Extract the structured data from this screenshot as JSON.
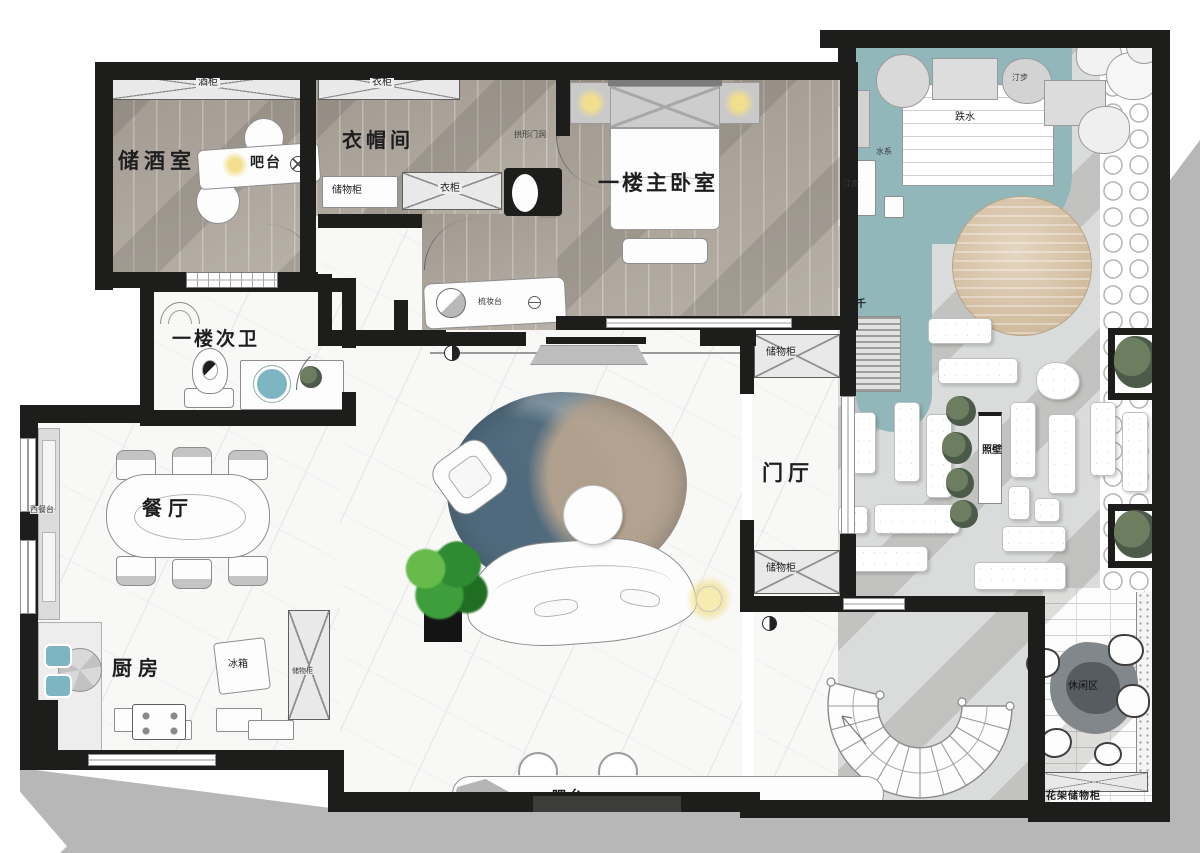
{
  "labels": {
    "wine_cabinet": "酒柜",
    "wine_room": "储酒室",
    "wine_bar": "吧台",
    "wardrobe_top": "衣柜",
    "cloakroom": "衣帽间",
    "arched_doorway": "拱形门洞",
    "cloak_storage": "储物柜",
    "wardrobe_inner": "衣柜",
    "dressing_table": "梳妆台",
    "master_bedroom": "一楼主卧室",
    "guest_bathroom": "一楼次卫",
    "foyer": "门厅",
    "foyer_storage_top": "储物柜",
    "foyer_storage_bottom": "储物柜",
    "dining_room": "餐厅",
    "west_counter": "西餐台",
    "kitchen": "厨房",
    "fridge": "冰箱",
    "kitchen_storage": "储物柜",
    "bar_counter": "吧台",
    "stepping_stones_top": "汀步",
    "waterfall": "跌水",
    "water_system": "水系",
    "stepping_stones_left": "汀步",
    "swing": "秋千",
    "screen_wall": "照壁",
    "leisure_area": "休闲区",
    "flower_rack_storage": "花架储物柜"
  },
  "colors": {
    "wall": "#1d1d1b",
    "water_teal": "#92b7ba",
    "wood_floor": "#b7b0a6",
    "wood_deck": "#d7c0a0",
    "lamp_glow": "#f1df8e",
    "rug_blue": "#4f6a7c",
    "rug_tan": "#b3a28f",
    "plant_green": "#3e9e3c",
    "garden_paving": "#dadcdb",
    "exterior_shadow": "#b7b7b7",
    "sink_teal": "#7eb5c3"
  }
}
